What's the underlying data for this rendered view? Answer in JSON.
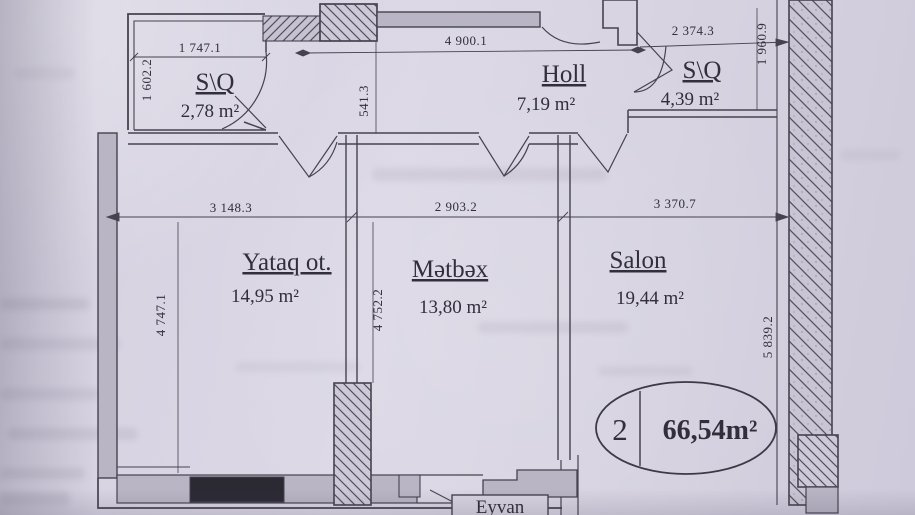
{
  "paper": {
    "background": "#d8d4e1",
    "ink": "#46434f",
    "wall_gray": "#b9b5c4",
    "window_black": "#2b2a33"
  },
  "rooms": {
    "sq_left": {
      "name": "S\\Q",
      "area": "2,78 m²"
    },
    "holl": {
      "name": "Holl",
      "area": "7,19 m²"
    },
    "sq_right": {
      "name": "S\\Q",
      "area": "4,39 m²"
    },
    "yataq": {
      "name": "Yataq ot.",
      "area": "14,95 m²"
    },
    "metbex": {
      "name": "Mətbəx",
      "area": "13,80 m²"
    },
    "salon": {
      "name": "Salon",
      "area": "19,44 m²"
    },
    "eyvan": {
      "name": "Eyvan"
    }
  },
  "dims": {
    "top_left": "1 747.1",
    "top_mid": "4 900.1",
    "top_right": "2 374.3",
    "mid_left": "3 148.3",
    "mid_center": "2 903.2",
    "mid_right": "3 370.7",
    "v_left_top": "1 602.2",
    "v_left": "4 747.1",
    "v_mid_top": "541.3",
    "v_mid": "4 752.2",
    "v_right_top": "1 960.9",
    "v_right": "5 839.2"
  },
  "badge": {
    "number": "2",
    "area": "66,54m²"
  }
}
